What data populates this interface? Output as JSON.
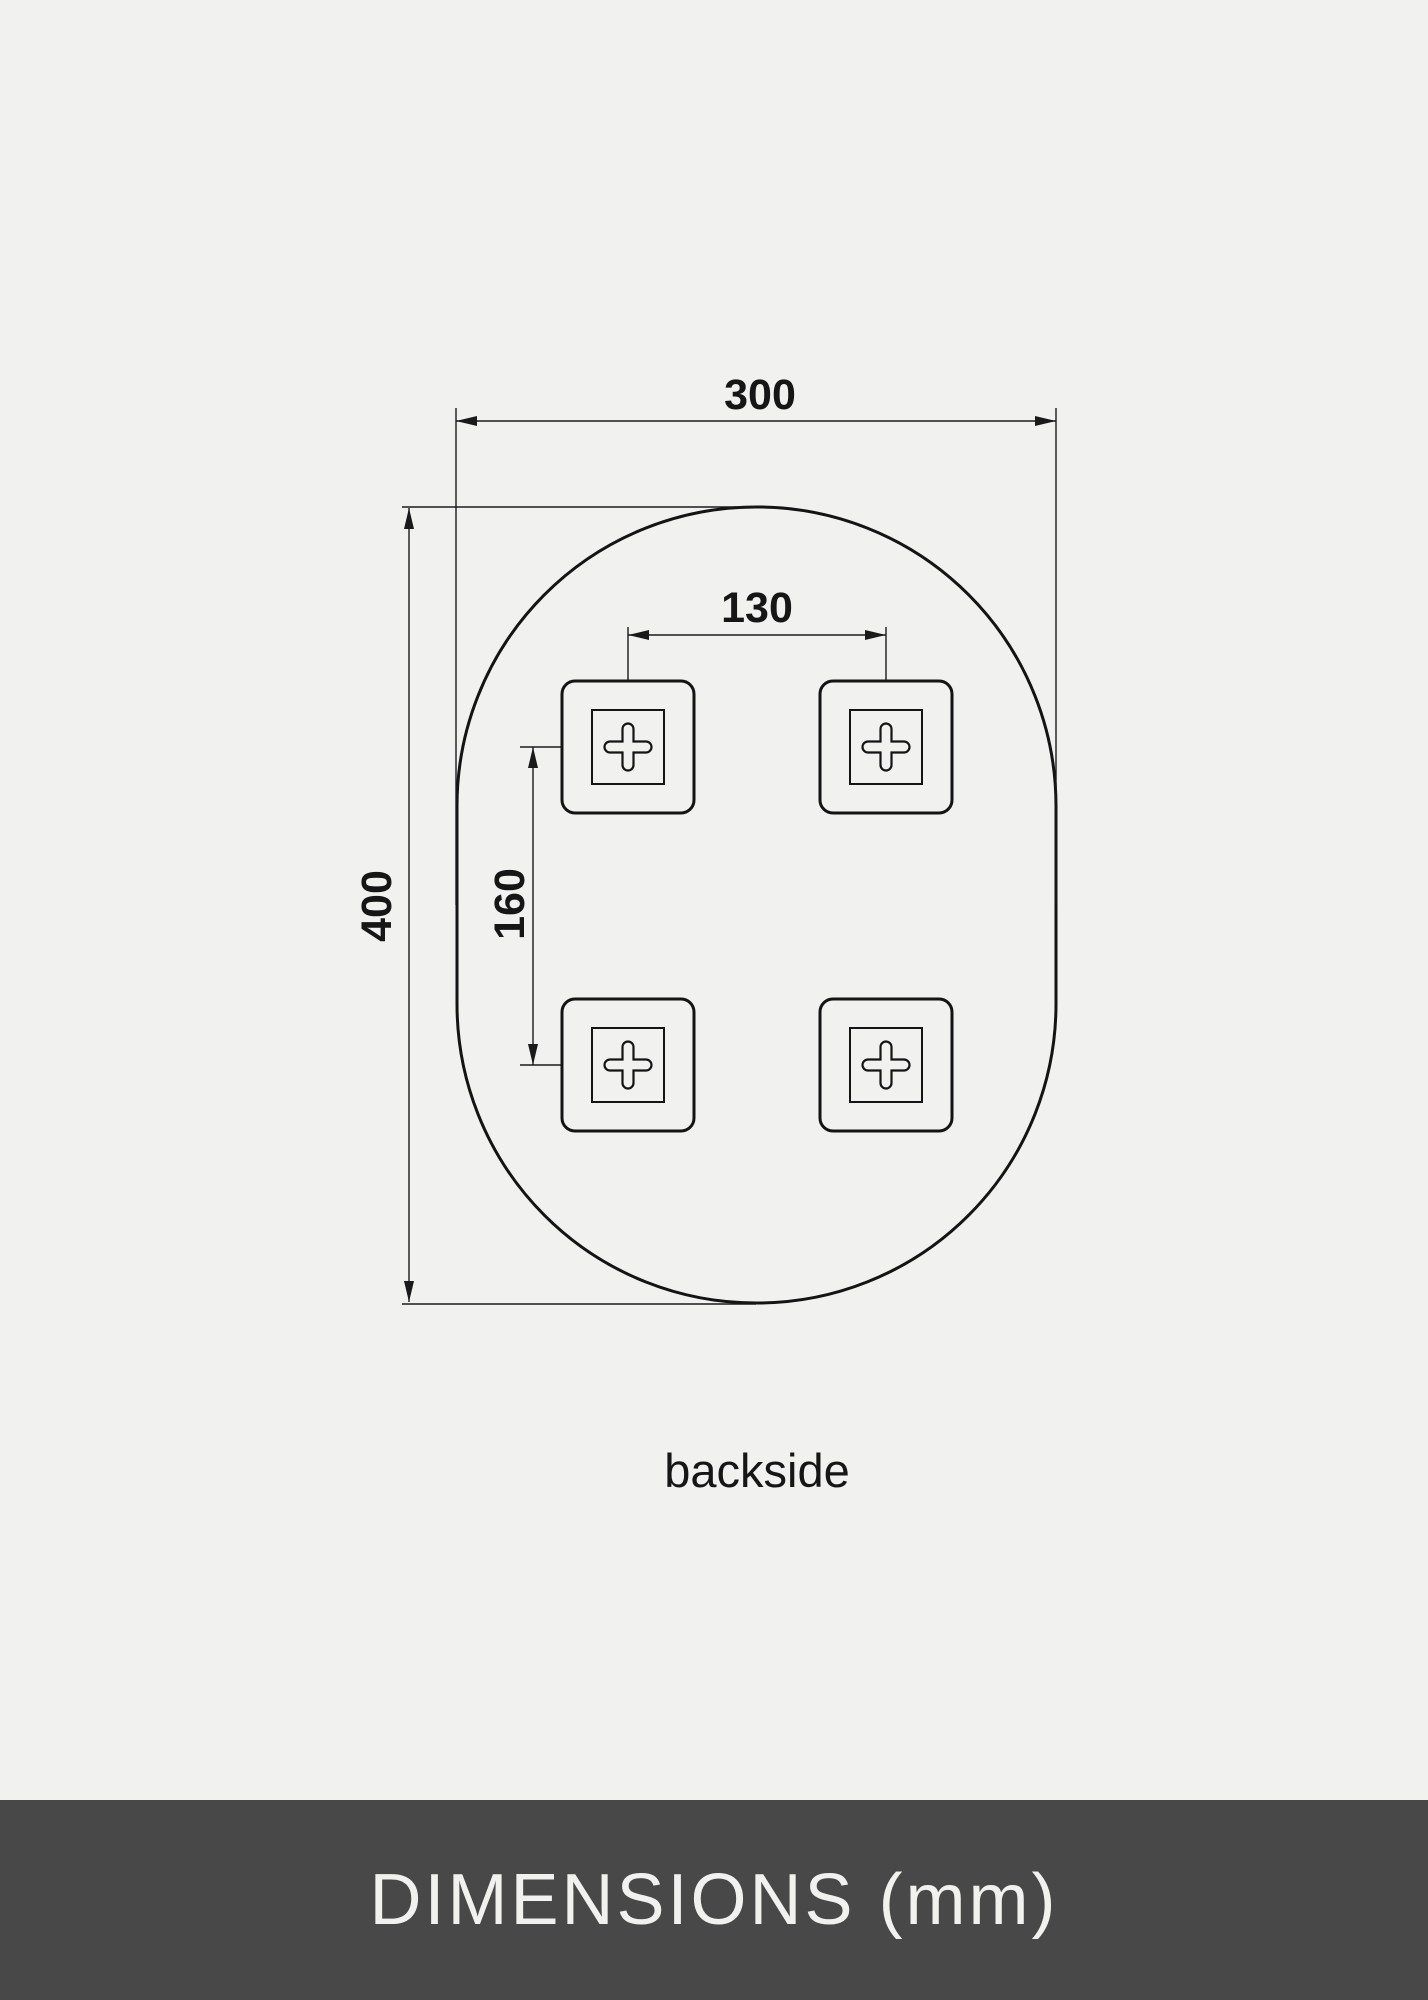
{
  "page": {
    "background_color": "#f1f1f0",
    "line_color": "#1a1a1a"
  },
  "diagram": {
    "view_label": "backside",
    "width_mm": "300",
    "height_mm": "400",
    "hole_spacing_horizontal_mm": "130",
    "hole_spacing_vertical_mm": "160",
    "shape": "oval-mirror-outline",
    "mount_points": 4
  },
  "footer": {
    "title": "DIMENSIONS (mm)",
    "background_color": "#484848",
    "text_color": "#f1f1ef"
  }
}
